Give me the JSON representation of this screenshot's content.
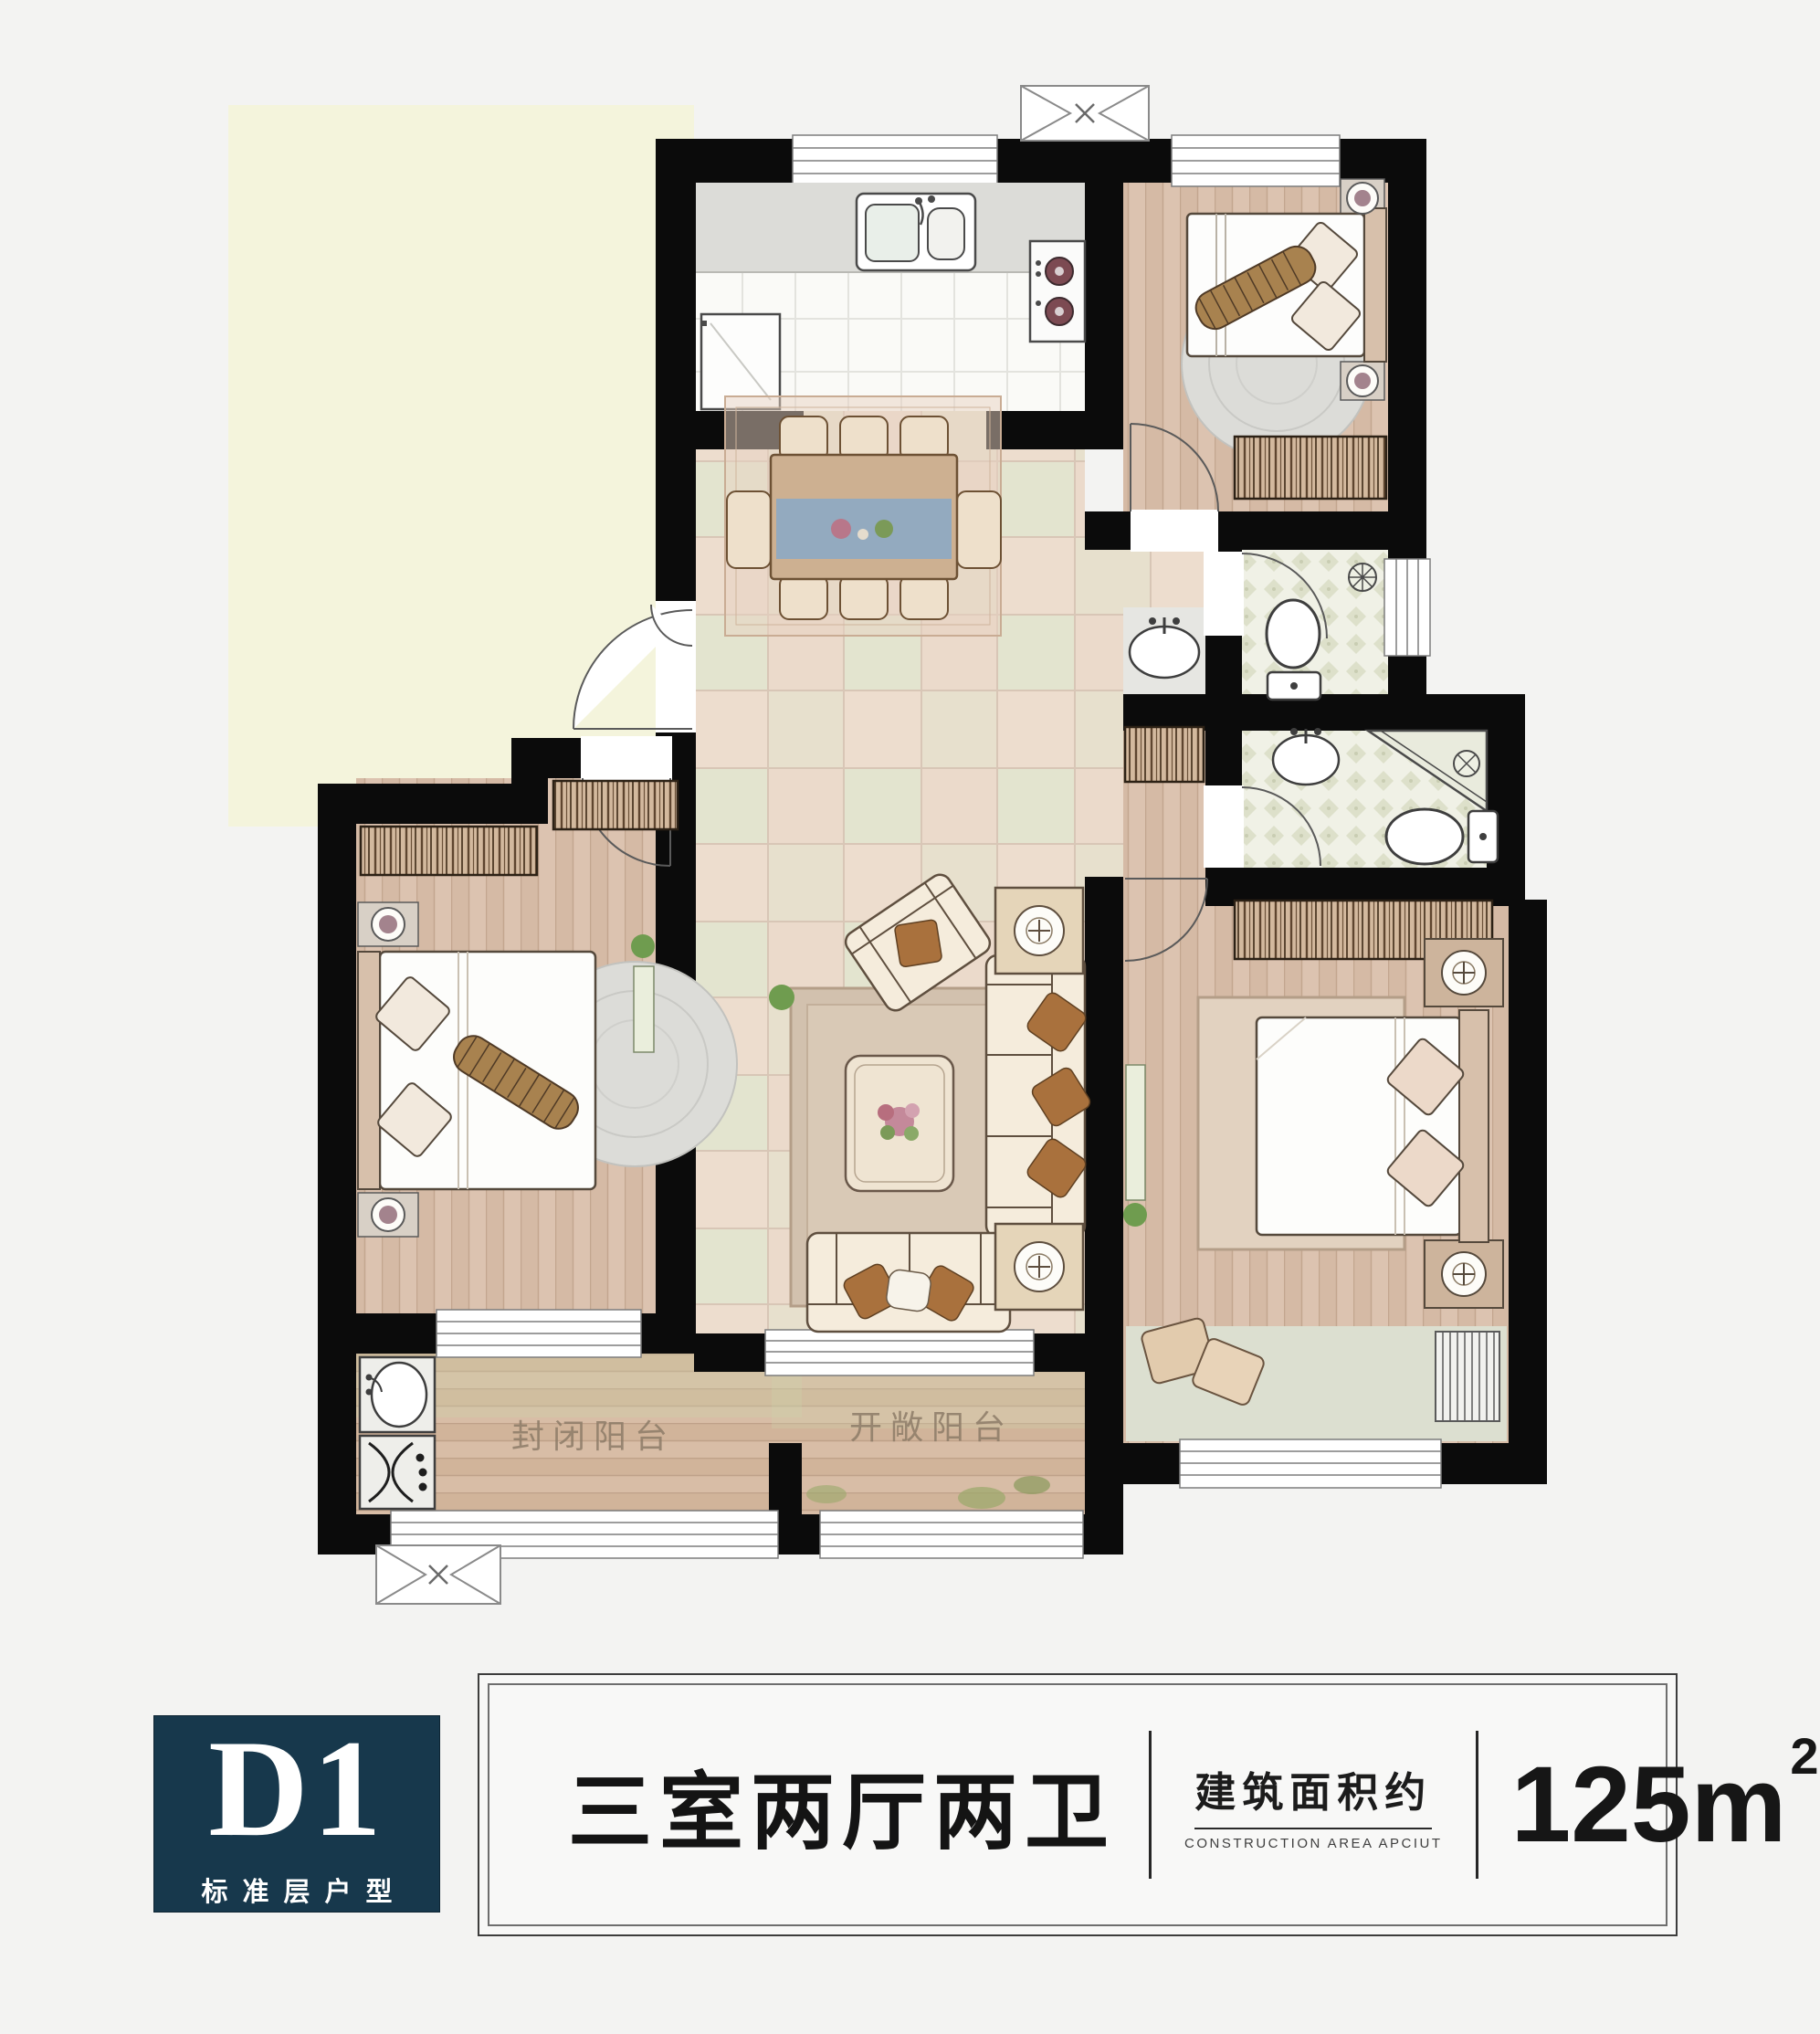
{
  "plan": {
    "balcony_enclosed_label": "封闭阳台",
    "balcony_open_label": "开敞阳台"
  },
  "footer": {
    "unit_code": "D1",
    "unit_code_caption": "标准层户型",
    "layout_title": "三室两厅两卫",
    "area_label_cn": "建筑面积约",
    "area_label_en": "CONSTRUCTION AREA APCIUT",
    "area_value": "125m",
    "area_sup": "2"
  },
  "colors": {
    "badge_navy": "#17384c",
    "wall_black": "#0b0b0b",
    "exterior_yellow": "#f4f4dc",
    "tile_floor": "#ebdacb",
    "wood_floor": "#dcc3b0"
  }
}
